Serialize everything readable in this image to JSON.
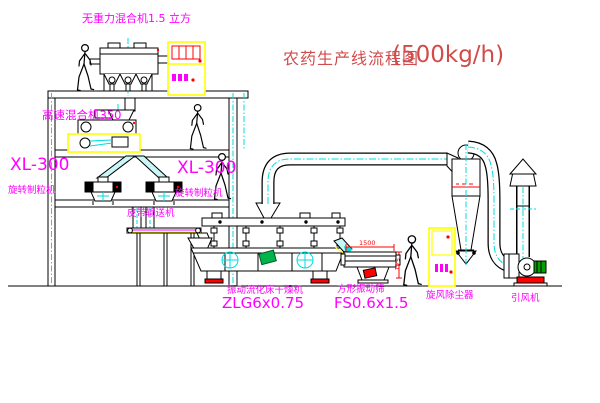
{
  "title": {
    "name": "农药生产线流程图",
    "capacity": "(500kg/h)"
  },
  "equipment_labels": {
    "gravity_free_mixer": "无重力混合机1.5 立方",
    "high_speed_mixer": "高速混合机350",
    "granulator_left": {
      "model": "XL-300",
      "name": "旋转制粒机"
    },
    "granulator_center": {
      "model": "XL-300",
      "name": "旋转制粒机"
    },
    "belt_conveyor": "皮带输送机",
    "fluid_bed_dryer": {
      "name": "振动流化床干燥机",
      "model": "ZLG6x0.75"
    },
    "square_vibrating_sieve": {
      "name": "方形振动筛",
      "model": "FS0.6x1.5"
    },
    "cyclone_dust_collector": "旋风除尘器",
    "induced_draft_fan": "引风机"
  },
  "dimensions": {
    "sieve_length": "1500",
    "sieve_height": "541"
  },
  "colors": {
    "label_magenta": "#ff00ff",
    "title_red": "#d24b4b",
    "line_black": "#000000",
    "centerline_cyan": "#00dcdc",
    "cabinet_yellow": "#ffff00",
    "accent_red": "#ff0000",
    "motor_green": "#00a000"
  }
}
